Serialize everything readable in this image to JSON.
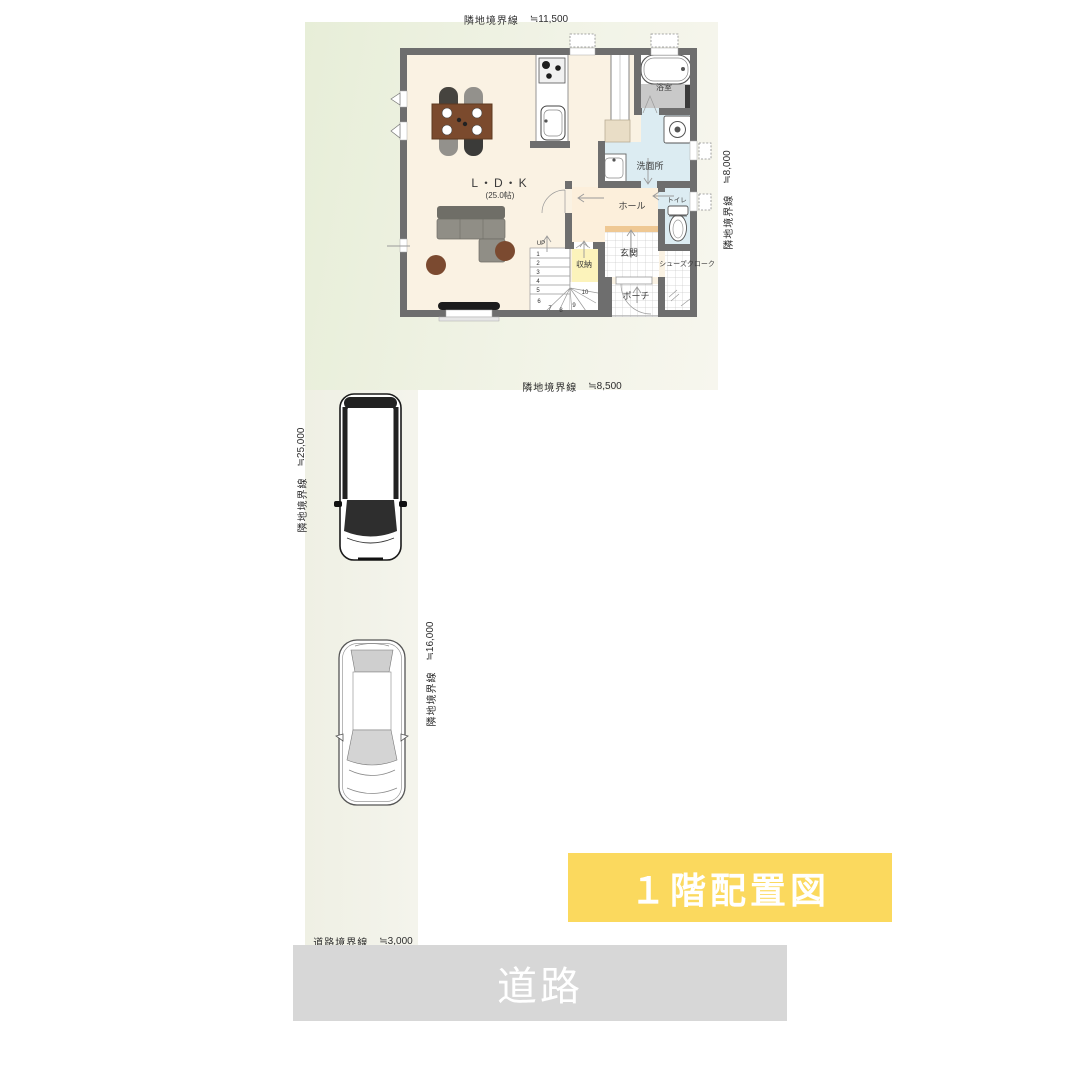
{
  "banner": {
    "text": "１階配置図",
    "bg": "#FBD95E",
    "text_color": "#FFFFFF"
  },
  "road": {
    "label": "道路",
    "bg": "#D7D7D7",
    "text_color": "#FFFFFF"
  },
  "plan": {
    "boundary_labels": {
      "top": {
        "name": "隣地境界線",
        "value": "≒11,500"
      },
      "middle": {
        "name": "隣地境界線",
        "value": "≒8,500"
      },
      "right": {
        "name": "隣地境界線",
        "value": "≒8,000"
      },
      "left": {
        "name": "隣地境界線",
        "value": "≒25,000"
      },
      "driveway": {
        "name": "隣地境界線",
        "value": "≒16,000"
      },
      "road": {
        "name": "道路境界線",
        "value": "≒3,000"
      }
    },
    "rooms": {
      "ldk_name": "L・D・K",
      "ldk_size": "(25.0帖)",
      "bath": "浴室",
      "washroom": "洗面所",
      "hall": "ホール",
      "toilet": "トイレ",
      "storage": "収納",
      "entrance": "玄関",
      "shoe_closet": "シューズクローク",
      "porch": "ポーチ"
    },
    "stairs": {
      "up": "UP",
      "steps": [
        "1",
        "2",
        "3",
        "4",
        "5",
        "6",
        "7",
        "8",
        "9",
        "10"
      ]
    }
  },
  "colors": {
    "wall": "#6E6E6E",
    "floor": "#FAF2E3",
    "hall_floor": "#FCEFDB",
    "wet_room_floor": "#DCECF2",
    "storage_floor": "#FCF3BB",
    "entrance_step": "#EFC893",
    "bath_floor": "#C9C9C9",
    "lot_green": "#E7EED8",
    "banner_yellow": "#FBD95E",
    "road_gray": "#D7D7D7"
  }
}
